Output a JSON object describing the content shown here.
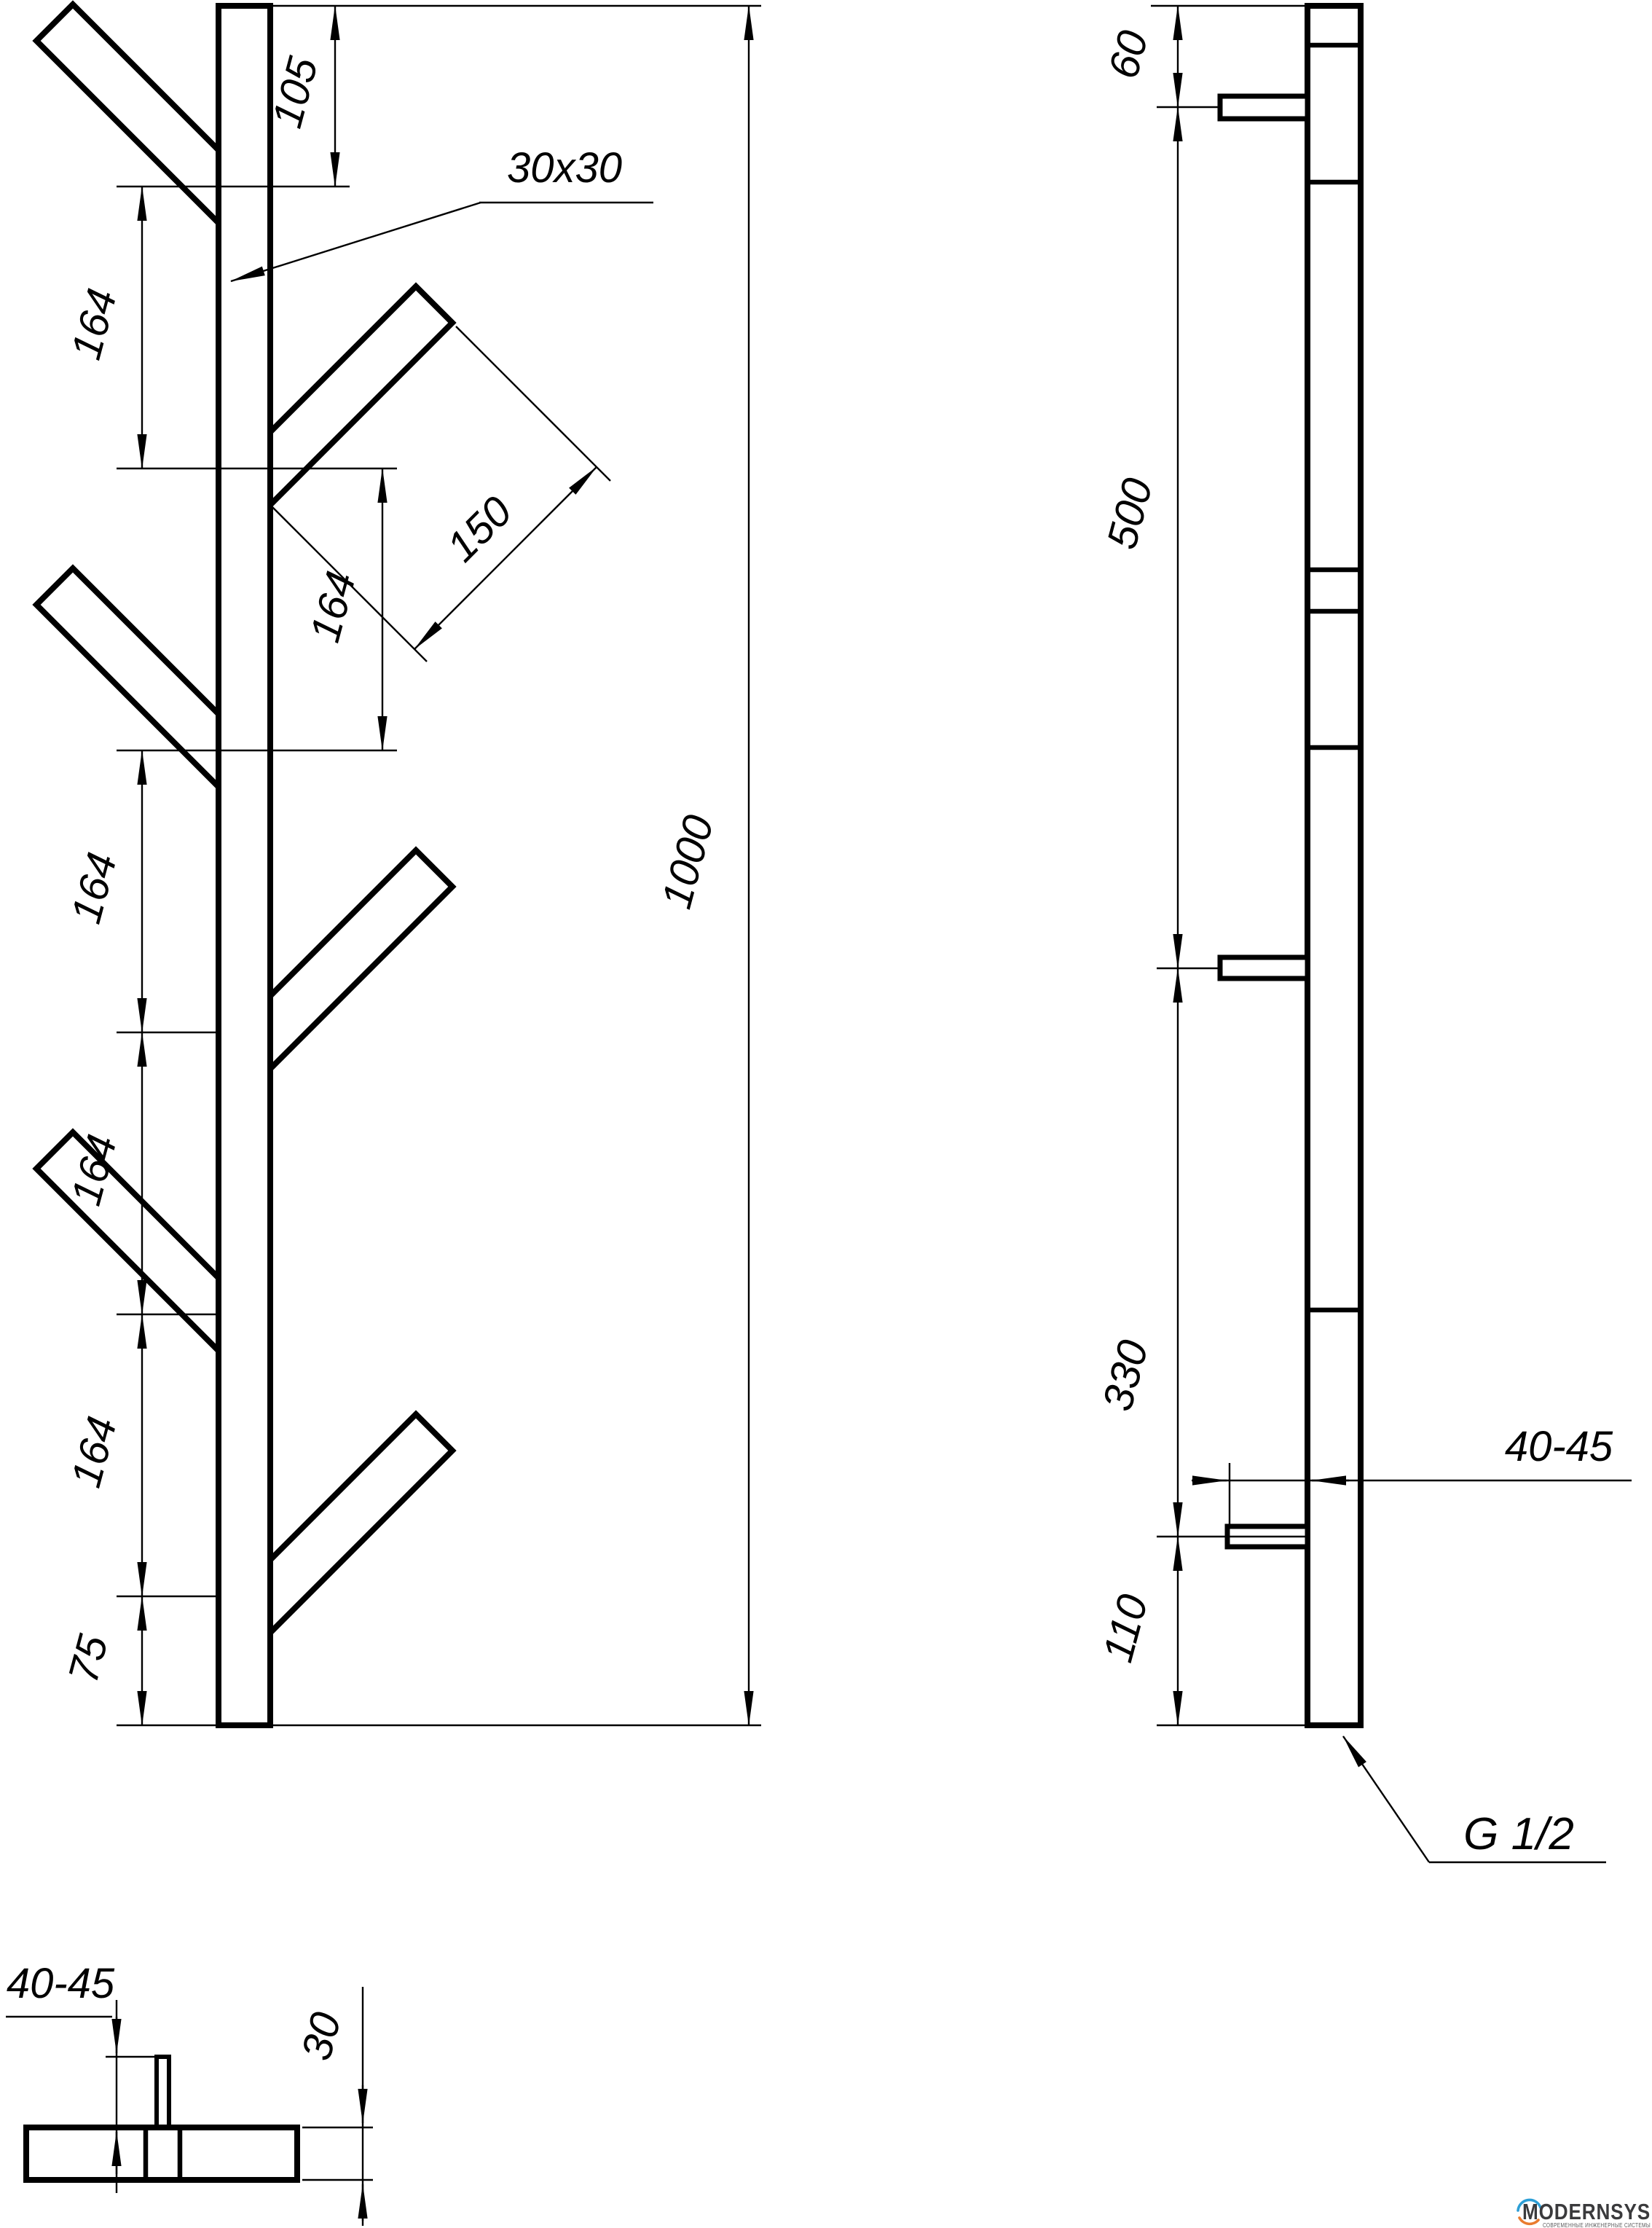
{
  "front": {
    "profile": "30x30",
    "chain": [
      "105",
      "164",
      "164",
      "164",
      "164",
      "164",
      "75"
    ],
    "branch_length": "150",
    "total": "1000"
  },
  "side": {
    "chain": [
      "60",
      "500",
      "330",
      "110"
    ],
    "bracket_offset": "40-45",
    "thread": "G 1/2"
  },
  "top": {
    "bracket_offset": "40-45",
    "depth": "30"
  },
  "logo": {
    "name": "MODERNSYS",
    "tagline": "СОВРЕМЕННЫЕ ИНЖЕНЕРНЫЕ СИСТЕМЫ",
    "accent_blue": "#2d9fd6",
    "accent_orange": "#e97c2f",
    "ink": "#3a3a3c",
    "tag_ink": "#58585a"
  }
}
